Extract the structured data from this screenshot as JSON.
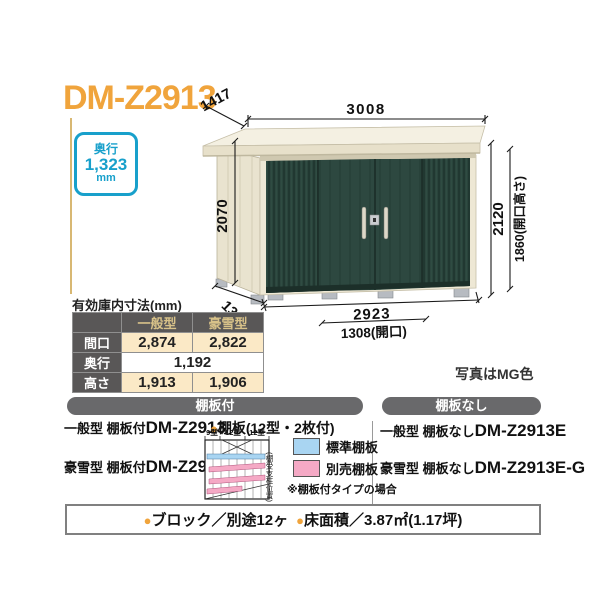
{
  "title": "DM-Z2913",
  "depth_badge": {
    "label": "奥行",
    "value": "1,323",
    "unit": "mm"
  },
  "drawing": {
    "width_top": "3008",
    "depth_top": "1417",
    "height_left": "2070",
    "height_right": "2120",
    "opening_height": "1860(開口高さ)",
    "depth_bottom": "1323",
    "width_bottom": "2923",
    "opening_width": "1308(開口)",
    "photo_note": "写真はMG色"
  },
  "spec_table": {
    "title": "有効庫内寸法(mm)",
    "columns": [
      "一般型",
      "豪雪型"
    ],
    "rows": {
      "maguchi": {
        "label": "間口",
        "general": "2,874",
        "gosetsu": "2,822"
      },
      "okuyuki": {
        "label": "奥行",
        "both": "1,192"
      },
      "takasa": {
        "label": "高さ",
        "general": "1,913",
        "gosetsu": "1,906"
      }
    }
  },
  "shelf_section": {
    "header": "棚板付",
    "general_prefix": "一般型 棚板付",
    "general_model": "DM-Z2913",
    "gosetsu_prefix": "豪雪型 棚板付",
    "gosetsu_model": "DM-Z2913-G",
    "shelf_spec": {
      "bullet": "●",
      "text": "棚板(12型・2枚付)"
    },
    "diagram": {
      "labels": [
        "9型",
        "12型",
        "12型"
      ],
      "side_note": "(棚受支柱位置)"
    },
    "legend": {
      "standard": "標準棚板",
      "optional": "別売棚板",
      "standard_color": "#A9D5F2",
      "optional_color": "#F5A9C5"
    },
    "note": "※棚板付タイプの場合"
  },
  "no_shelf_section": {
    "header": "棚板なし",
    "general_prefix": "一般型 棚板なし",
    "general_model": "DM-Z2913E",
    "gosetsu_prefix": "豪雪型 棚板なし",
    "gosetsu_model": "DM-Z2913E-G"
  },
  "footer": {
    "items": [
      {
        "bullet": "●",
        "text": "ブロック／別途12ヶ"
      },
      {
        "bullet": "●",
        "text": "床面積／3.87㎡(1.17坪)"
      }
    ]
  },
  "colors": {
    "accent_orange": "#F0A43C",
    "badge_blue": "#18A0CB",
    "shed_green": "#2A443C",
    "frame_cream": "#EEE8D5",
    "bar_gray": "#69696B",
    "table_header_dark": "#595757",
    "table_cell_cream": "#FBE9C6",
    "legend_blue": "#A9D5F2",
    "legend_pink": "#F5A9C5"
  }
}
